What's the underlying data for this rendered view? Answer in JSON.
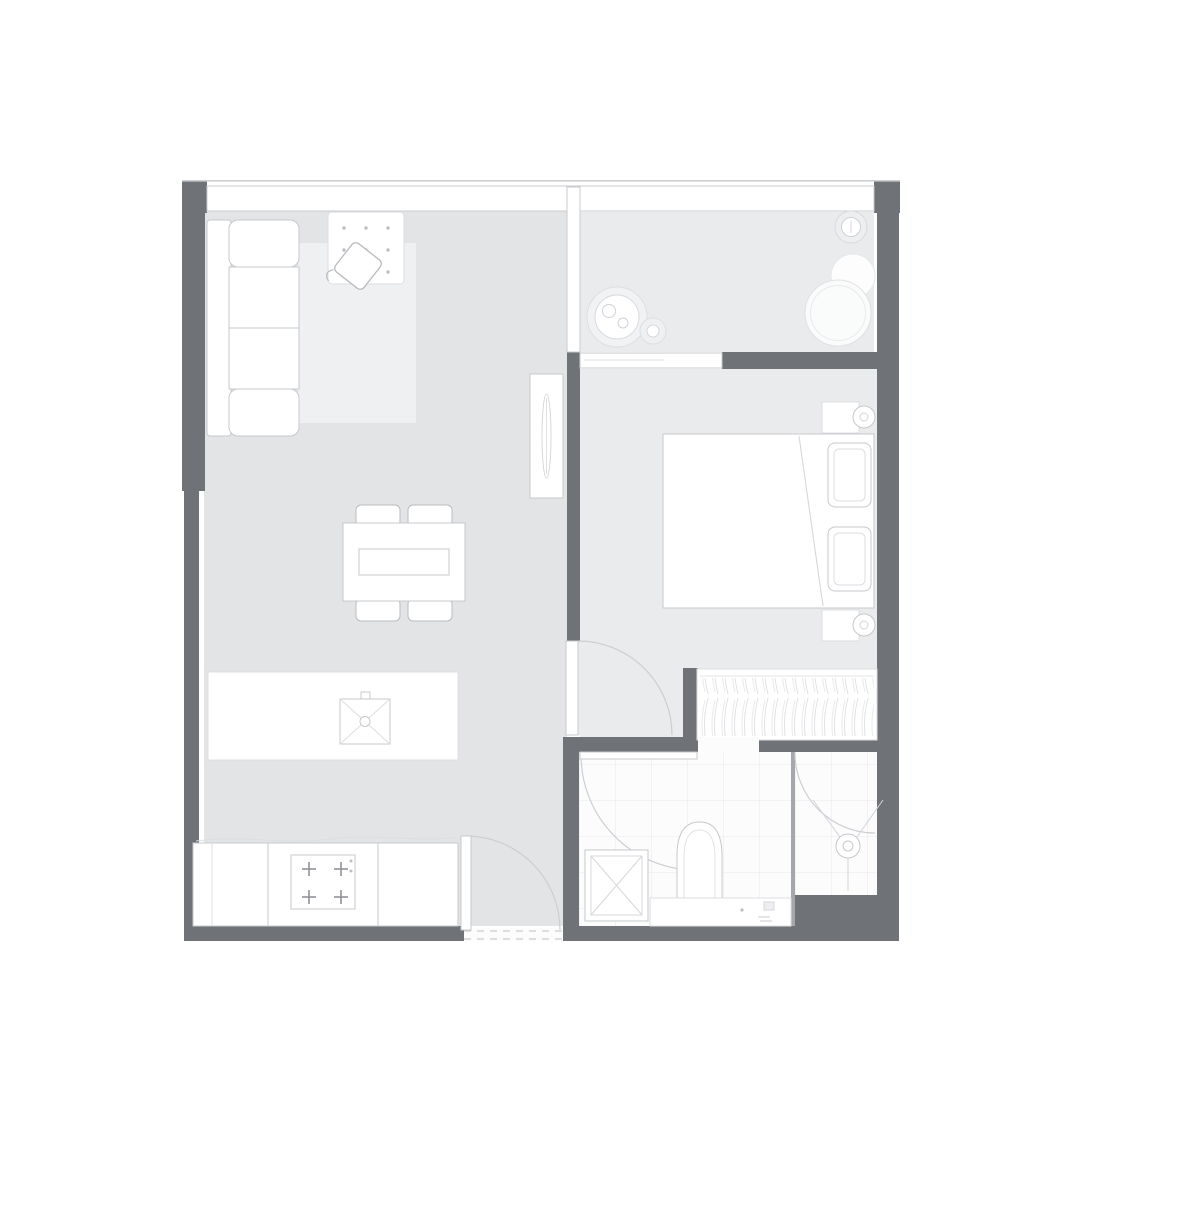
{
  "palette": {
    "background": "#ffffff",
    "wall": "#6f7377",
    "floor_living": "#e3e4e6",
    "floor_bedroom": "#eaebec",
    "floor_balcony": "#eaebec",
    "floor_bath": "#fcfcfd",
    "tile_line": "#e7e8ea",
    "rug": "#eef0f2",
    "furniture_fill": "#ffffff",
    "furniture_stroke": "#c6c8cc",
    "soft_stroke": "#dcdee1",
    "arc_stroke": "#ccced2",
    "glass_stroke": "#c9cbce",
    "divider": "#a4a7ab",
    "dot": "#bcbfc3"
  },
  "plan": {
    "type": "floor-plan",
    "rooms": [
      {
        "name": "living-dining-kitchen"
      },
      {
        "name": "balcony"
      },
      {
        "name": "bedroom"
      },
      {
        "name": "bathroom"
      },
      {
        "name": "shower-room"
      }
    ],
    "furniture": [
      {
        "name": "sofa",
        "room": "living-dining-kitchen"
      },
      {
        "name": "rug",
        "room": "living-dining-kitchen"
      },
      {
        "name": "ottoman-dotted",
        "room": "living-dining-kitchen"
      },
      {
        "name": "armchair",
        "room": "living-dining-kitchen"
      },
      {
        "name": "floor-mirror",
        "room": "living-dining-kitchen"
      },
      {
        "name": "dining-table",
        "room": "living-dining-kitchen"
      },
      {
        "name": "dining-chairs",
        "count": 4,
        "room": "living-dining-kitchen"
      },
      {
        "name": "kitchen-island-with-sink",
        "room": "living-dining-kitchen"
      },
      {
        "name": "kitchen-counter-with-stove",
        "room": "living-dining-kitchen"
      },
      {
        "name": "potted-plant-large",
        "room": "balcony"
      },
      {
        "name": "potted-plant-small",
        "room": "balcony"
      },
      {
        "name": "round-table",
        "room": "balcony"
      },
      {
        "name": "round-chair",
        "room": "balcony"
      },
      {
        "name": "double-bed-with-pillows",
        "room": "bedroom"
      },
      {
        "name": "nightstand-with-lamp",
        "count": 2,
        "room": "bedroom"
      },
      {
        "name": "wardrobe-with-hangers",
        "room": "bedroom"
      },
      {
        "name": "washing-machine",
        "room": "bathroom"
      },
      {
        "name": "toilet",
        "room": "bathroom"
      },
      {
        "name": "vanity-counter",
        "room": "bathroom"
      },
      {
        "name": "shower-head",
        "room": "shower-room"
      }
    ],
    "doors": [
      {
        "name": "entry-door",
        "between": [
          "outside",
          "living-dining-kitchen"
        ]
      },
      {
        "name": "bedroom-door",
        "between": [
          "living-dining-kitchen",
          "bedroom"
        ]
      },
      {
        "name": "bathroom-door",
        "between": [
          "living-dining-kitchen",
          "bathroom"
        ]
      },
      {
        "name": "shower-door",
        "between": [
          "bathroom",
          "shower-room"
        ]
      },
      {
        "name": "sliding-glass-door",
        "between": [
          "balcony",
          "bedroom"
        ]
      }
    ],
    "windows": [
      {
        "name": "top-window-band"
      },
      {
        "name": "glass-partition-living-balcony"
      }
    ]
  }
}
